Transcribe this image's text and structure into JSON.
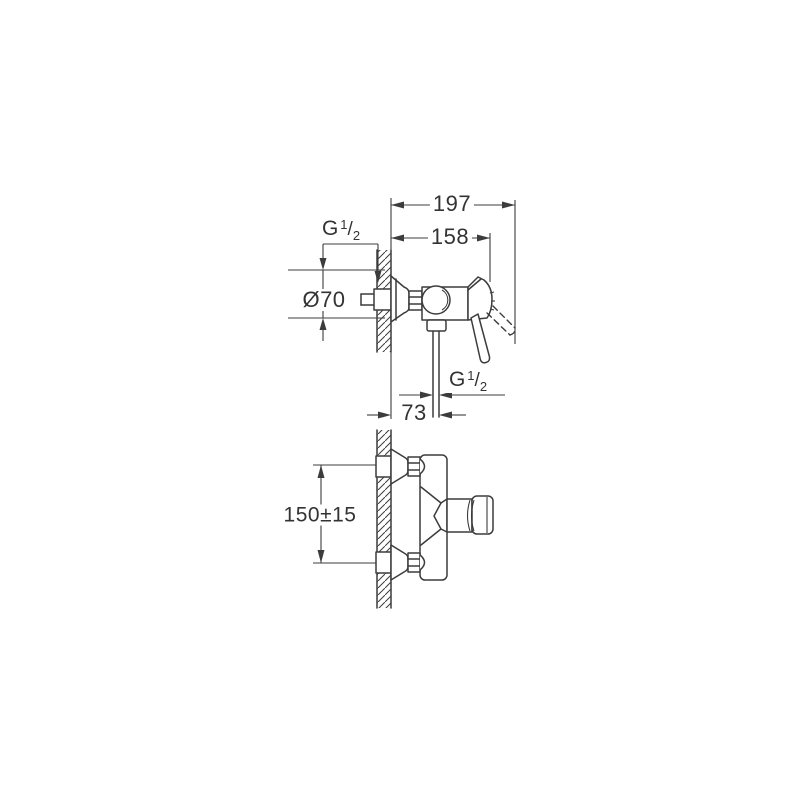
{
  "colors": {
    "background": "#ffffff",
    "line": "#3c3c3c",
    "text": "#333333"
  },
  "drawing": {
    "kind": "shower-mixer-installation-diagram",
    "side_view": {
      "dims": {
        "overall_depth": "197",
        "body_depth": "158",
        "flange_diameter": "Ø70",
        "outlet_offset": "73",
        "inlet_thread": {
          "prefix": "G",
          "sup": "1",
          "slash": "/",
          "sub": "2"
        },
        "outlet_thread": {
          "prefix": "G",
          "sup": "1",
          "slash": "/",
          "sub": "2"
        }
      }
    },
    "plan_view": {
      "dims": {
        "inlet_spacing": "150±15"
      }
    }
  }
}
